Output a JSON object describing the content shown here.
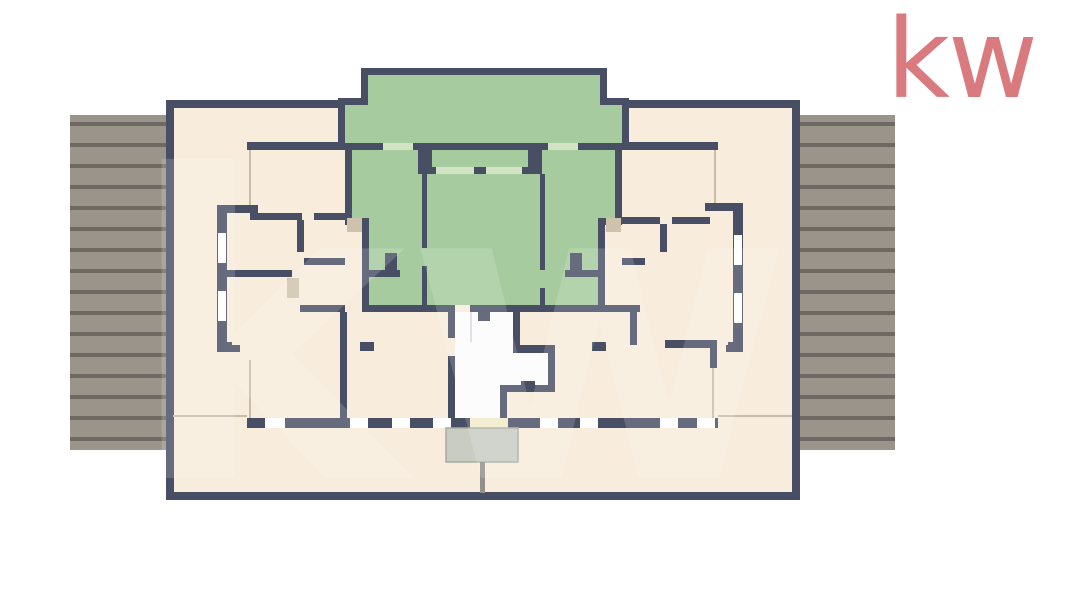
{
  "logo": {
    "text": "kw"
  },
  "watermark": {
    "text": "kw"
  },
  "colors": {
    "wall": "#484e64",
    "floor": "#f8ecdc",
    "unit": "#a5cb9e",
    "unit-window": "#d2e3c3",
    "deck": "#9a948a",
    "deck-stripe": "#6e6962",
    "cream": "#f1ebc9",
    "tan": "#cfc2ac",
    "canopy": "#c8ccc2",
    "canopy-edge": "#a8ab9f",
    "post": "#8e9089",
    "core": "#fcfcfd",
    "thin": "#c9bca9",
    "logo": "#d87a7e"
  },
  "floorplan": {
    "kind": "residential floor plan, top-down render",
    "highlighted_unit_location": "top-center",
    "regions": [
      "left-roof-deck",
      "right-roof-deck",
      "building-shell",
      "highlighted-unit",
      "left-apartment",
      "right-apartment",
      "stair-core",
      "elevator",
      "south-window-facade",
      "south-terrace",
      "entrance-canopy",
      "interior-columns"
    ]
  }
}
